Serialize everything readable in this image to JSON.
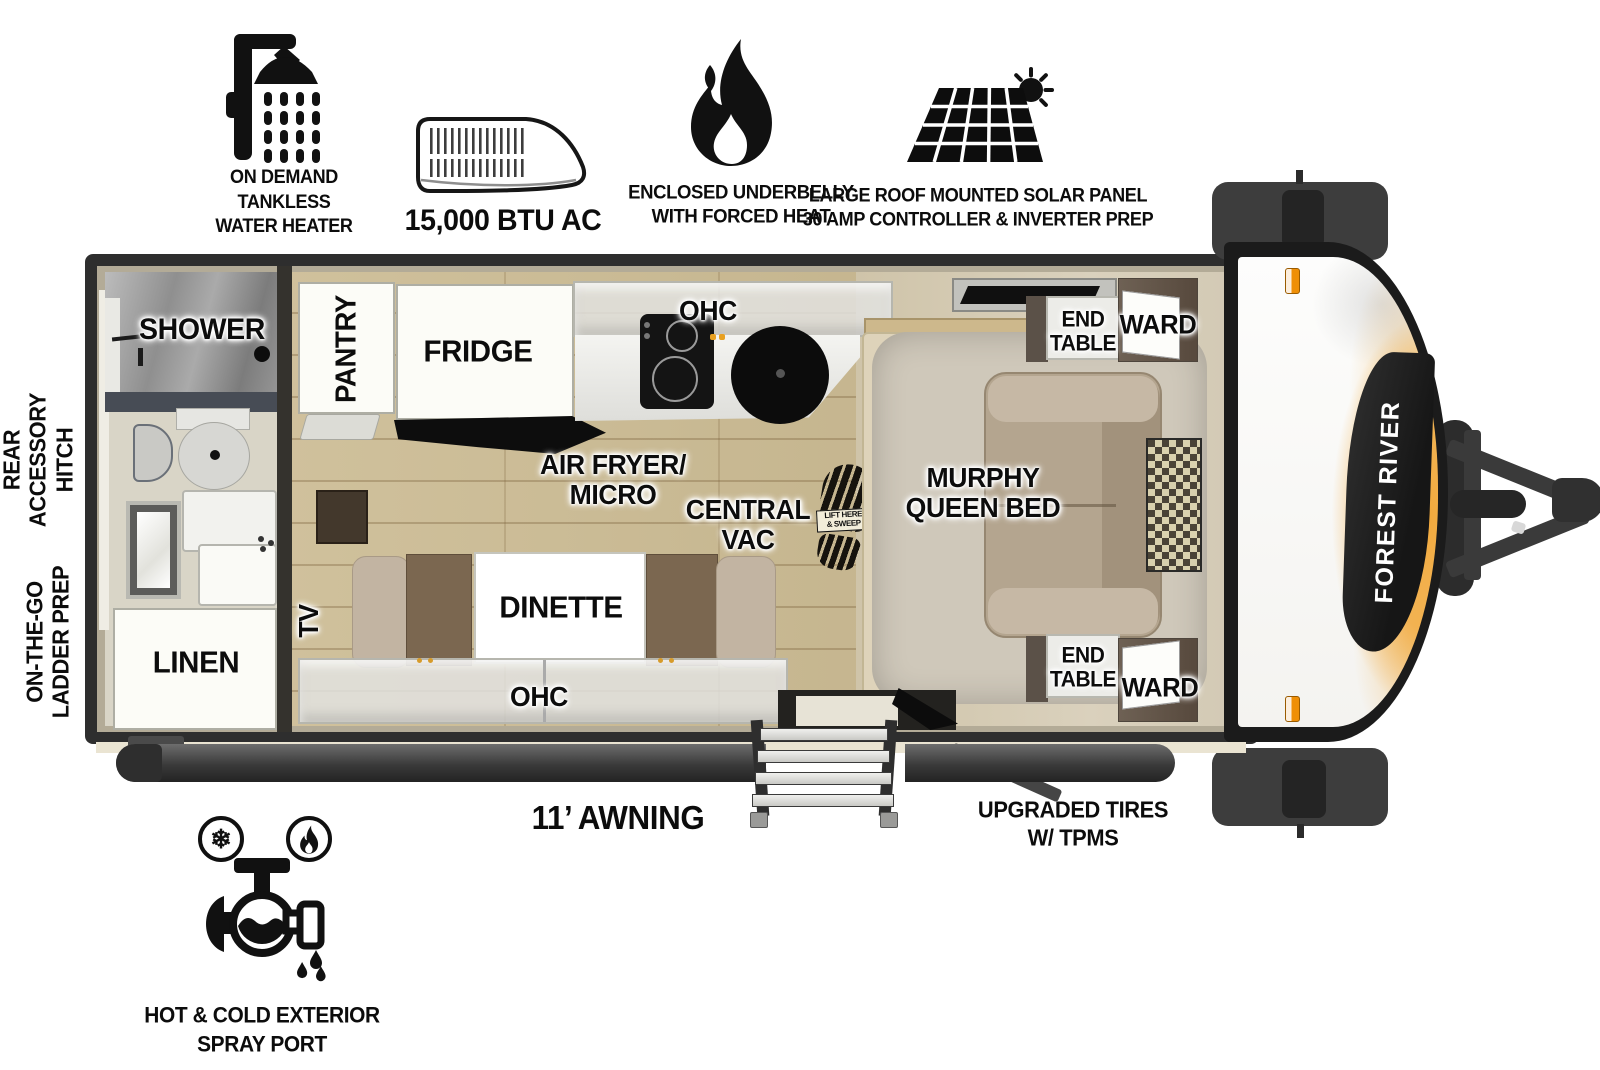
{
  "brand": {
    "name": "FOREST RIVER"
  },
  "features_top": {
    "water_heater": "ON DEMAND\nTANKLESS\nWATER HEATER",
    "ac": "15,000 BTU AC",
    "underbelly": "ENCLOSED UNDERBELLY\nWITH FORCED HEAT",
    "solar": "LARGE ROOF MOUNTED SOLAR PANEL\n30 AMP CONTROLLER & INVERTER PREP"
  },
  "exterior": {
    "rear_hitch": "REAR\nACCESSORY\nHITCH",
    "ladder_prep": "ON-THE-GO\nLADDER PREP",
    "awning": "11’ AWNING",
    "tires": "UPGRADED TIRES\nW/ TPMS",
    "spray_port": "HOT & COLD EXTERIOR\nSPRAY PORT"
  },
  "rooms": {
    "shower": "SHOWER",
    "linen": "LINEN",
    "pantry": "PANTRY",
    "fridge": "FRIDGE",
    "ohc_kitchen": "OHC",
    "air_fryer": "AIR FRYER/\nMICRO",
    "central_vac": "CENTRAL\nVAC",
    "vac_dustpan": "LIFT HERE\n& SWEEP",
    "murphy_bed": "MURPHY\nQUEEN BED",
    "end_table_top": "END\nTABLE",
    "ward_top": "WARD",
    "end_table_bottom": "END\nTABLE",
    "ward_bottom": "WARD",
    "tv": "TV",
    "dinette": "DINETTE",
    "ohc_living": "OHC"
  },
  "colors": {
    "accent_orange": "#f2a93c",
    "marker_orange": "#f08a00",
    "frame_dark": "#2e2e2e",
    "wood_floor": "#c9b88e",
    "bath_floor": "#d9d5c7",
    "ink": "#111111"
  }
}
